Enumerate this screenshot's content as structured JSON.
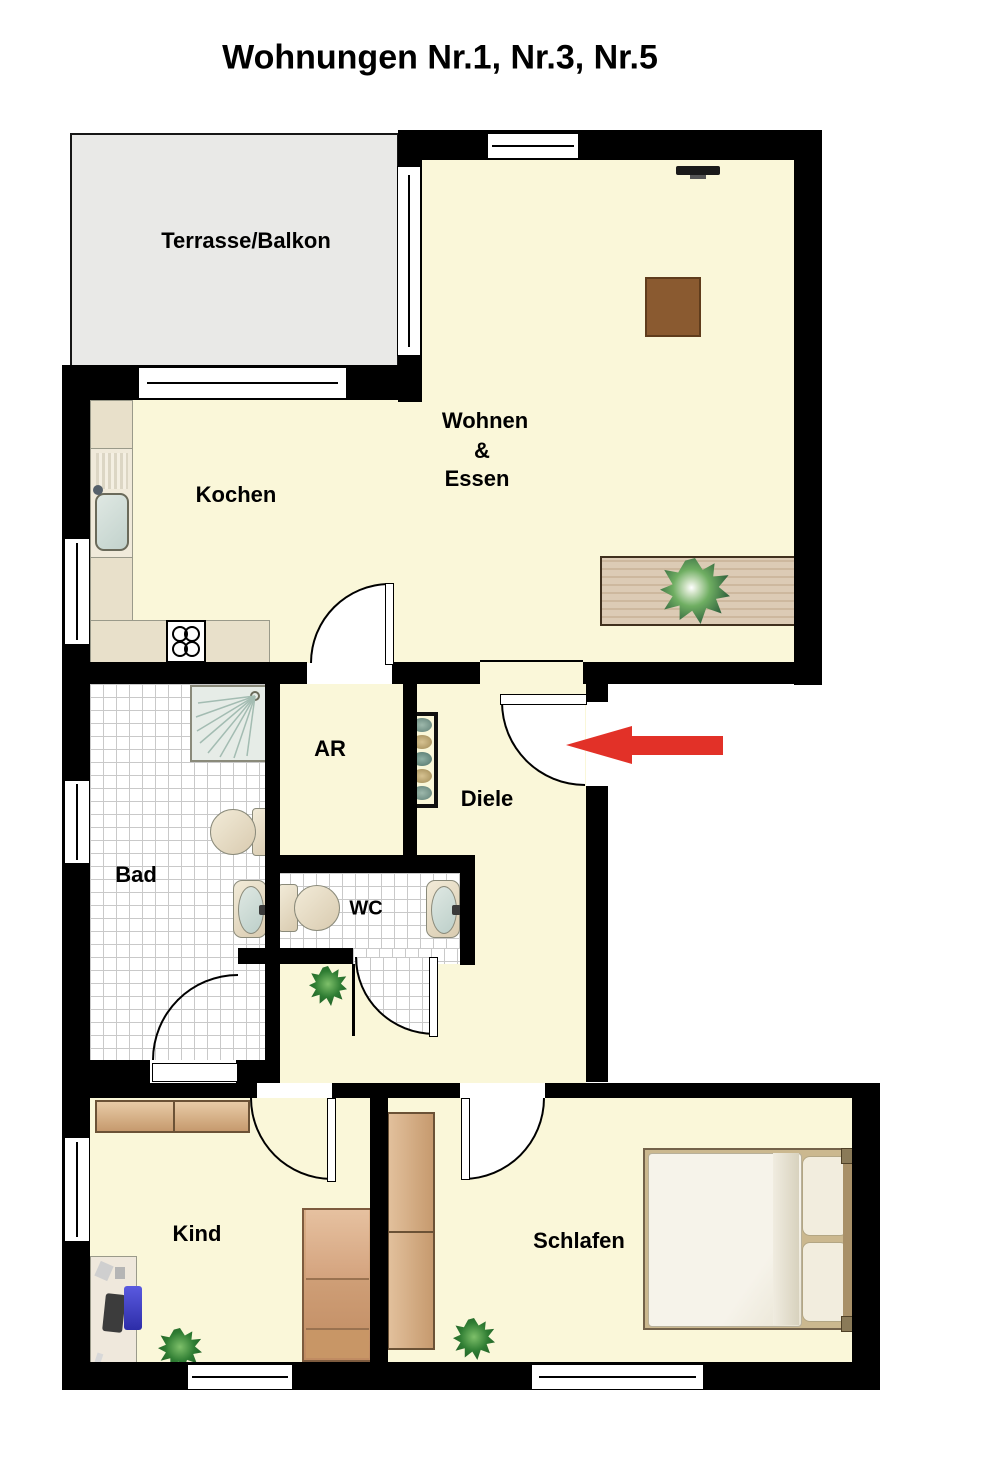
{
  "title": "Wohnungen Nr.1, Nr.3, Nr.5",
  "rooms": {
    "terrace": {
      "label": "Terrasse/Balkon"
    },
    "living": {
      "label1": "Wohnen",
      "label2": "&",
      "label3": "Essen"
    },
    "kitchen": {
      "label": "Kochen"
    },
    "storage": {
      "label": "AR"
    },
    "hall": {
      "label": "Diele"
    },
    "bath": {
      "label": "Bad"
    },
    "wc": {
      "label": "WC"
    },
    "child": {
      "label": "Kind"
    },
    "bedroom": {
      "label": "Schlafen"
    }
  },
  "colors": {
    "floor": "#FAF7D9",
    "terrace": "#E9E9E7",
    "wall": "#000000",
    "tile_line": "#C9C9C9",
    "counter": "#E8E0CA",
    "cabinet_tan": "#E9BE83",
    "wood_table": "#D9C7B0",
    "chair_brown": "#A75F28",
    "sofa_cream": "#EDE0BD",
    "rug_brown": "#8A5A30",
    "bed_duvet": "#F4F1E8",
    "wardrobe_tan": "#D4A878",
    "entrance_arrow_red": "#E23128",
    "plant_green": "#2F7D33"
  },
  "icons": {
    "entrance_arrow": "red arrow pointing left at apartment entrance door",
    "shower": "shower with spray lines",
    "stove": "4-burner cooktop",
    "sink": "kitchen sink",
    "coat_rack": "wardrobe hooks in hallway"
  }
}
